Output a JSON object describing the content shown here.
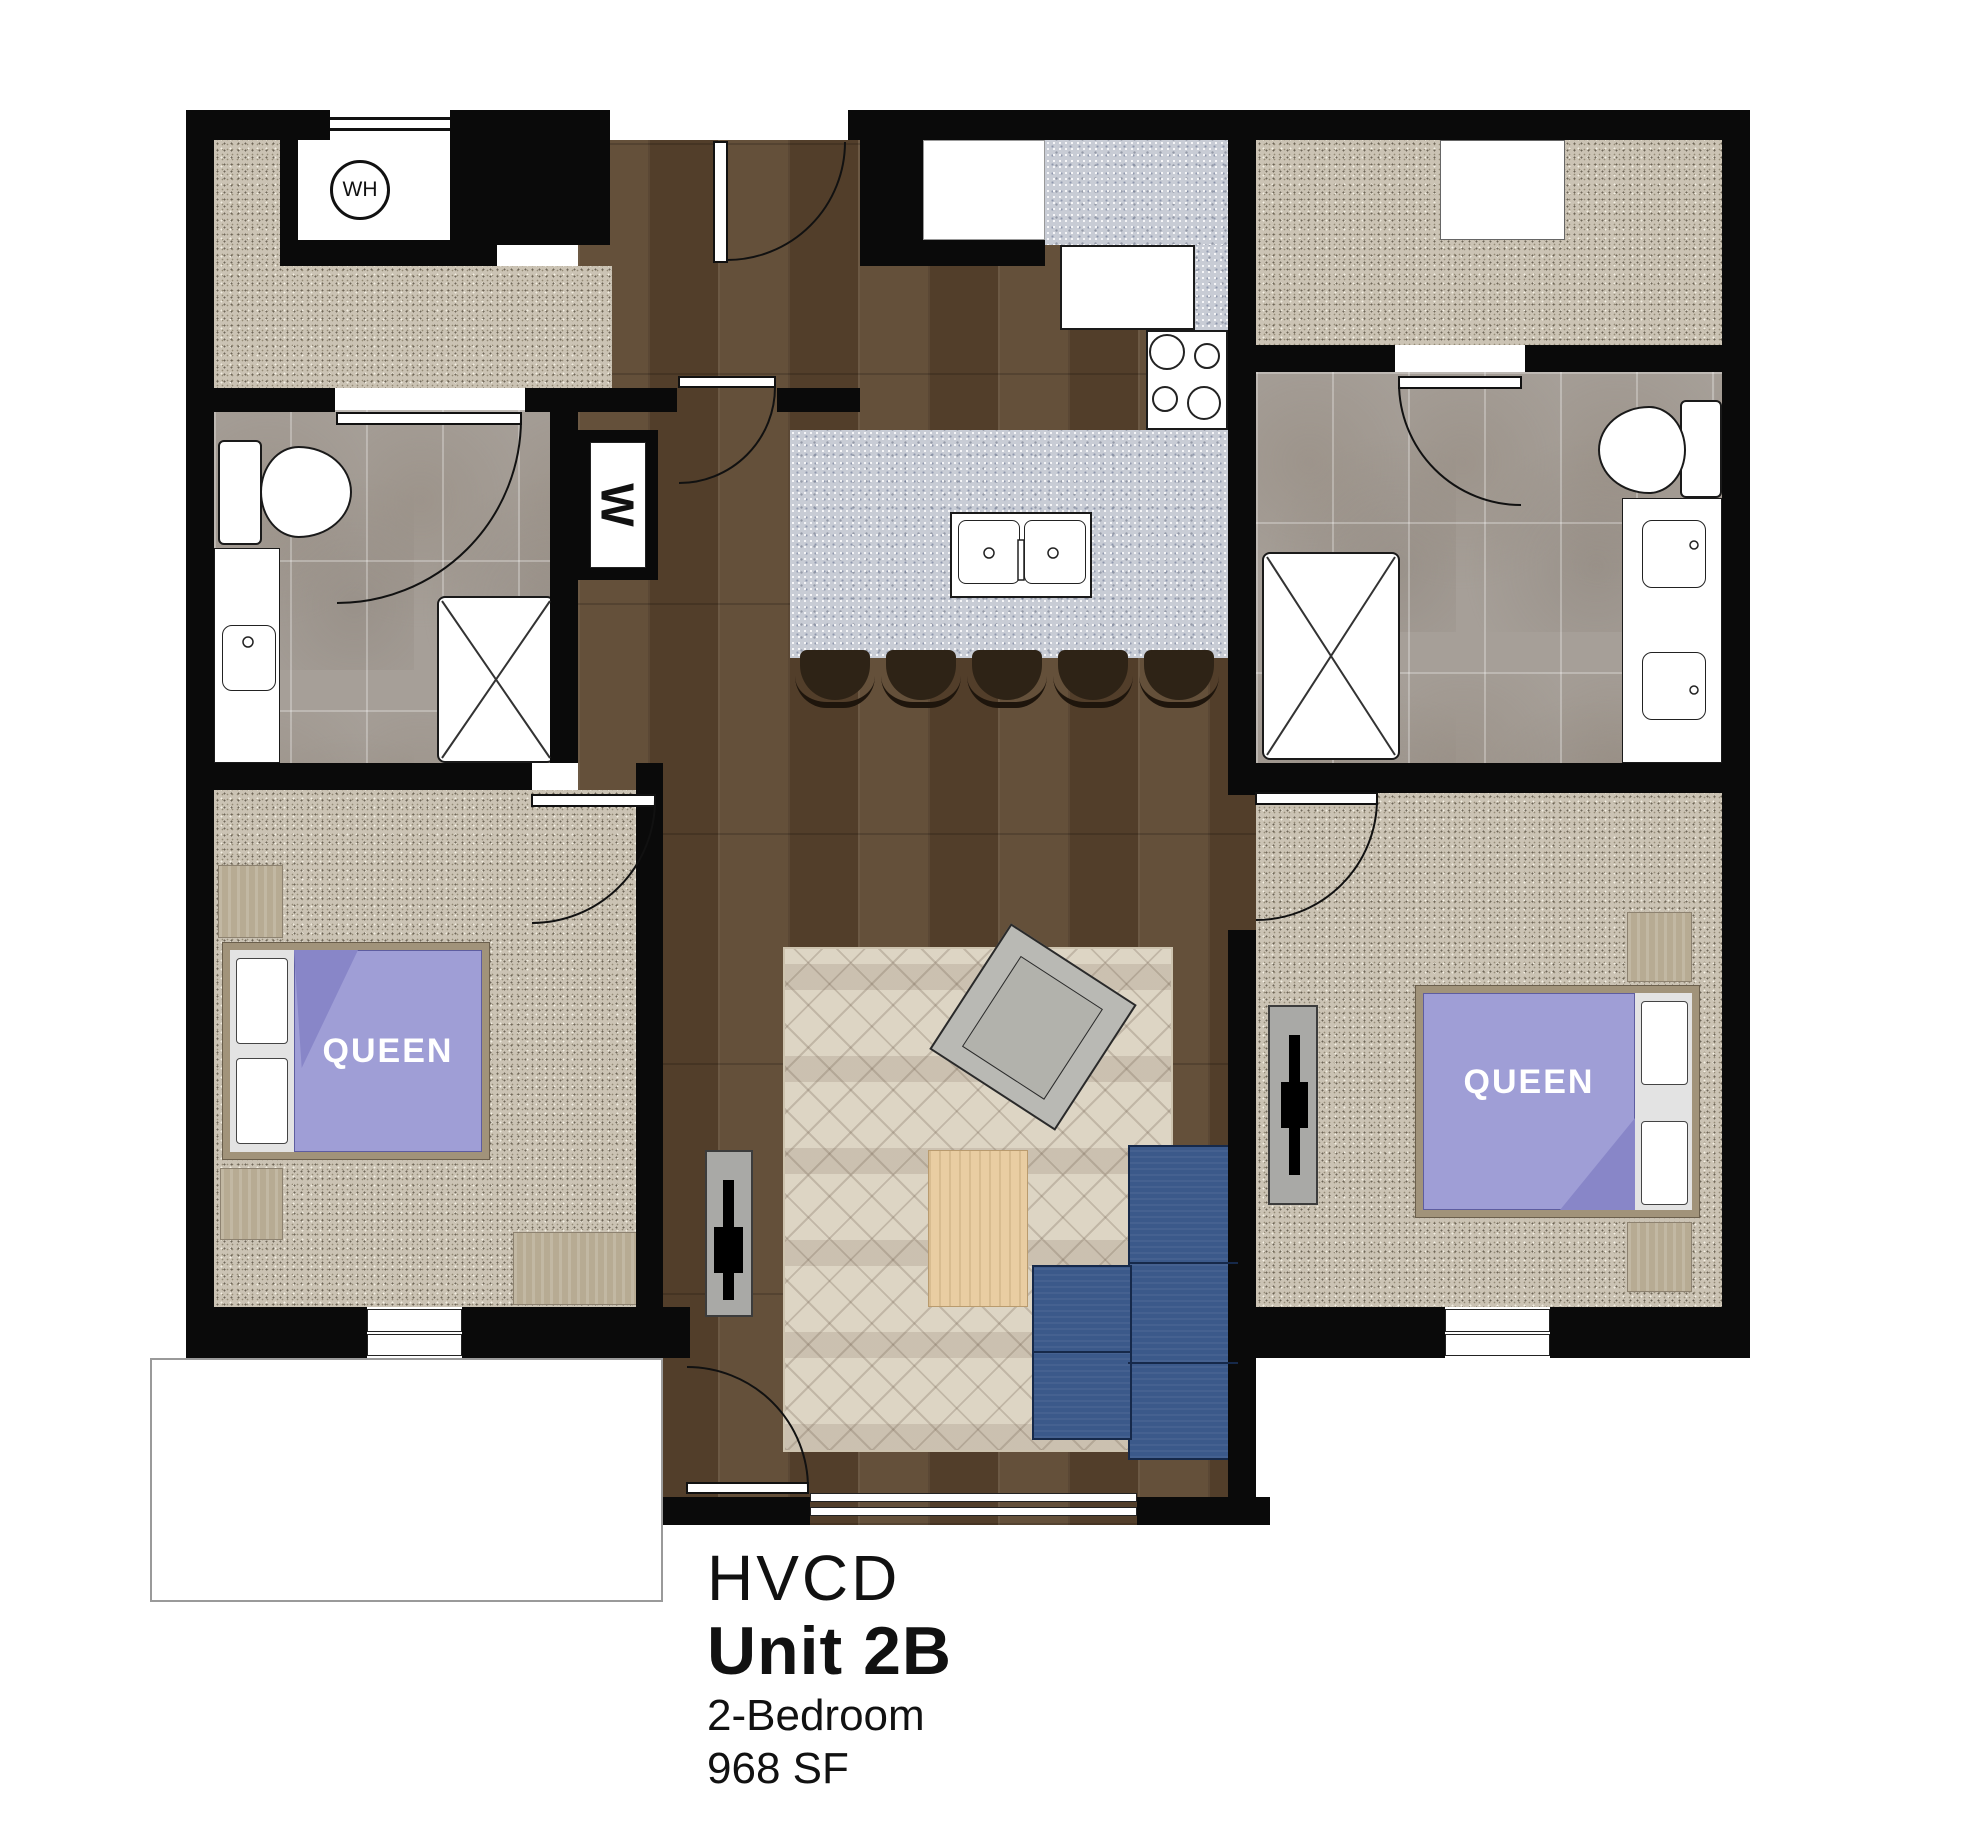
{
  "title_block": {
    "project": "HVCD",
    "unit": "Unit 2B",
    "type": "2-Bedroom",
    "area": "968 SF"
  },
  "labels": {
    "water_heater": "WH",
    "washer": "W",
    "bed_queen_1": "QUEEN",
    "bed_queen_2": "QUEEN"
  },
  "colors": {
    "wall": "#0a0a0a",
    "wood_floor": "#5a452f",
    "carpet": "#cbc3b4",
    "bath_tile": "#a69f98",
    "counter_granite": "#c8ccd5",
    "bed_spread": "#9f9ed6",
    "sofa_blue": "#3b598a",
    "furniture_tan": "#b7ab93",
    "rug": "#ddd5c4",
    "coffee_table": "#e9cda2"
  }
}
